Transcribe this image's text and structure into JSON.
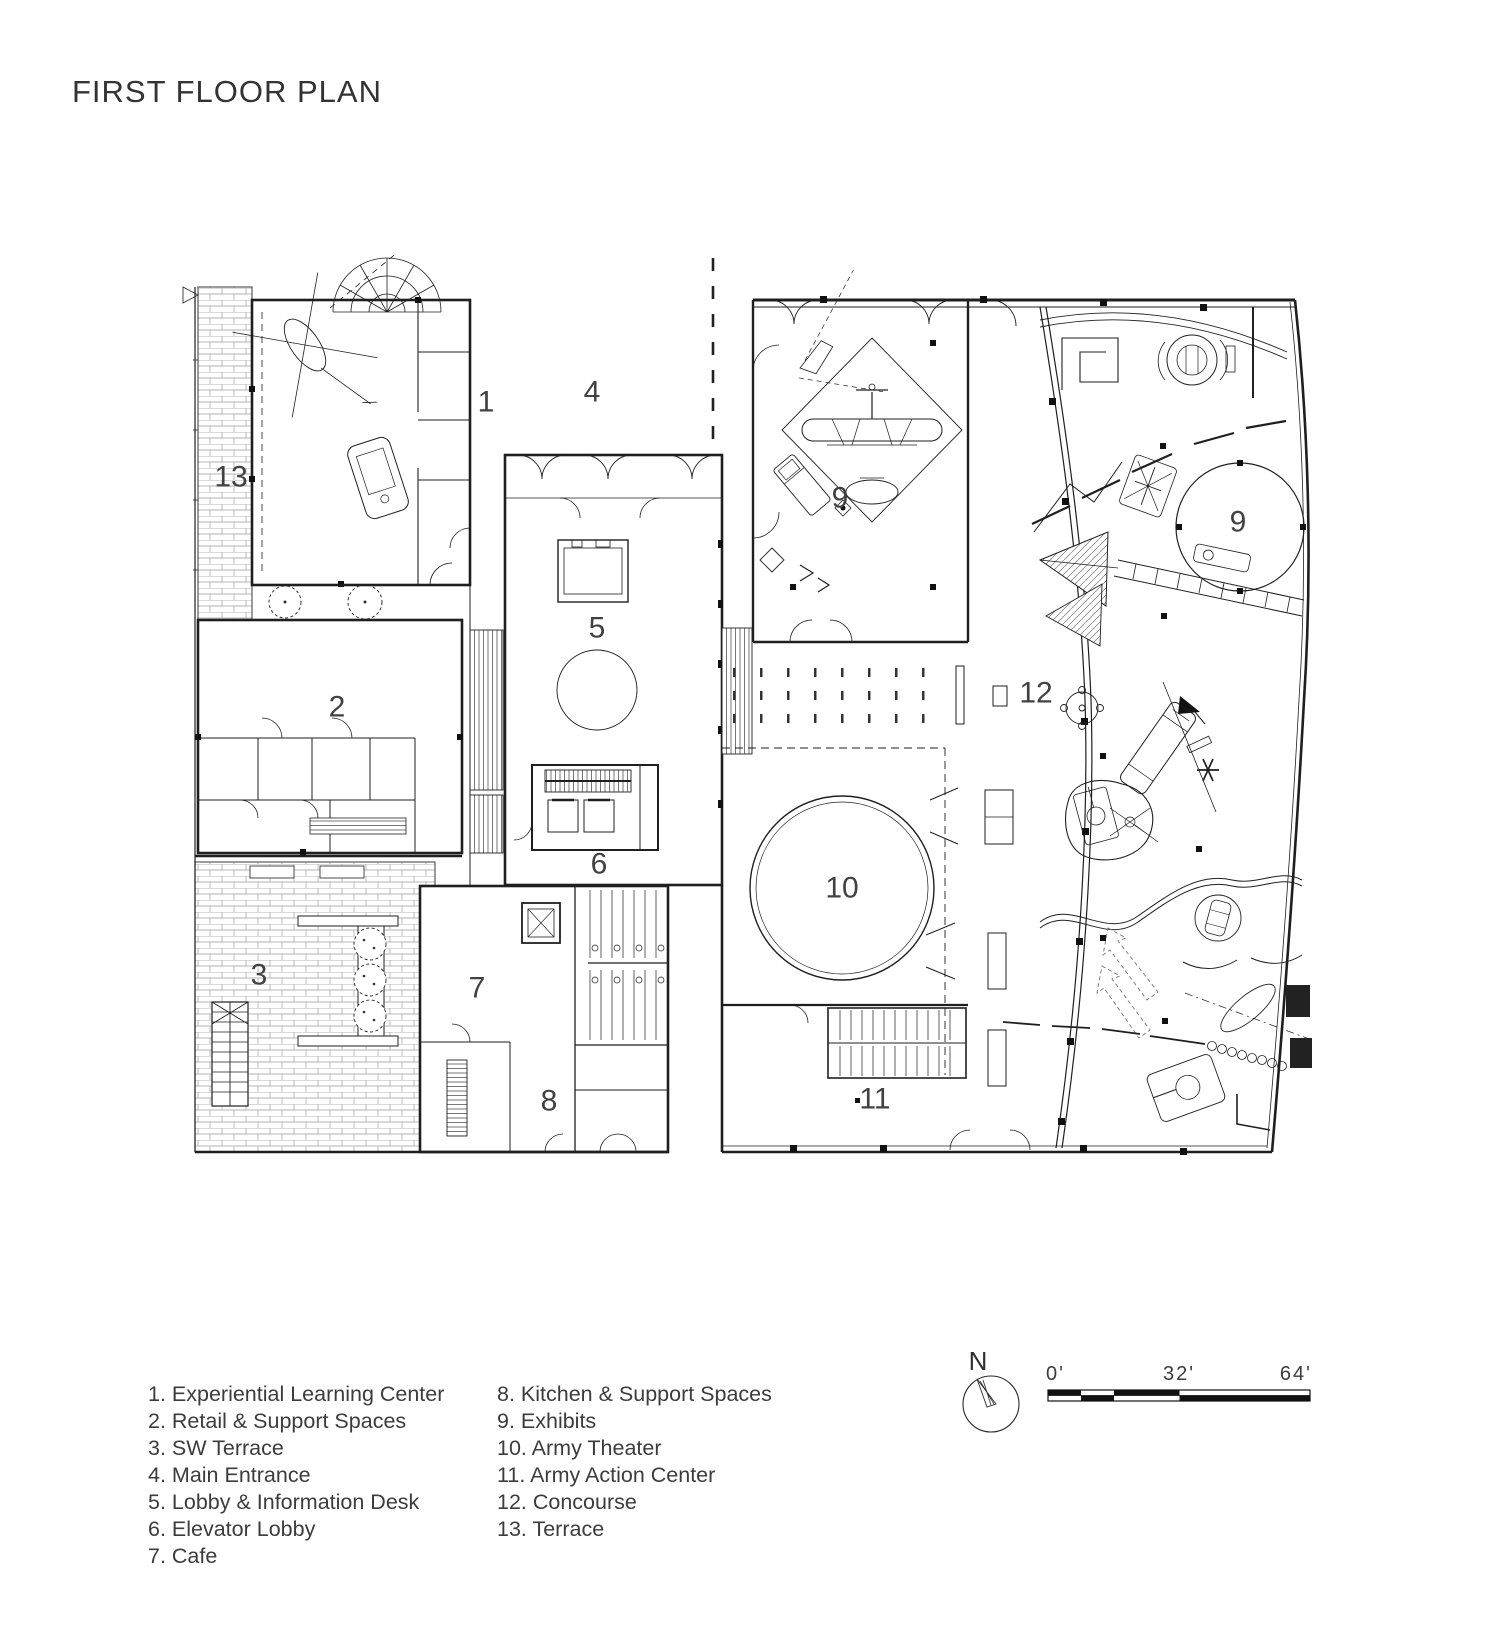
{
  "title": "FIRST FLOOR PLAN",
  "legend": {
    "column1": [
      "1. Experiential Learning Center",
      "2. Retail & Support Spaces",
      "3. SW Terrace",
      "4. Main Entrance",
      "5. Lobby & Information Desk",
      "6. Elevator Lobby",
      "7. Cafe"
    ],
    "column2": [
      "8. Kitchen & Support Spaces",
      "9. Exhibits",
      "10. Army Theater",
      "11. Army Action Center",
      "12. Concourse",
      "13. Terrace"
    ]
  },
  "plan_labels": [
    {
      "id": "experiential-learning-center",
      "text": "1",
      "x": 486,
      "y": 404
    },
    {
      "id": "retail-support",
      "text": "2",
      "x": 337,
      "y": 709
    },
    {
      "id": "sw-terrace",
      "text": "3",
      "x": 259,
      "y": 977
    },
    {
      "id": "main-entrance",
      "text": "4",
      "x": 592,
      "y": 394
    },
    {
      "id": "lobby-info-desk",
      "text": "5",
      "x": 597,
      "y": 630
    },
    {
      "id": "elevator-lobby",
      "text": "6",
      "x": 599,
      "y": 866
    },
    {
      "id": "cafe",
      "text": "7",
      "x": 477,
      "y": 990
    },
    {
      "id": "kitchen-support",
      "text": "8",
      "x": 549,
      "y": 1103
    },
    {
      "id": "exhibits-nw",
      "text": "9",
      "x": 840,
      "y": 500
    },
    {
      "id": "exhibits-east",
      "text": "9",
      "x": 1238,
      "y": 524
    },
    {
      "id": "army-theater",
      "text": "10",
      "x": 842,
      "y": 890
    },
    {
      "id": "army-action-center",
      "text": "11",
      "x": 875,
      "y": 1101
    },
    {
      "id": "concourse",
      "text": "12",
      "x": 1036,
      "y": 695
    },
    {
      "id": "terrace-13",
      "text": "13",
      "x": 231,
      "y": 479
    }
  ],
  "north_arrow": {
    "label": "N"
  },
  "scale_bar": {
    "labels": [
      "0'",
      "32'",
      "64'"
    ],
    "feet": [
      0,
      32,
      64
    ]
  },
  "colors": {
    "ink": "#1f1f1f",
    "brick": "#b5b5b5",
    "label": "#414141"
  }
}
